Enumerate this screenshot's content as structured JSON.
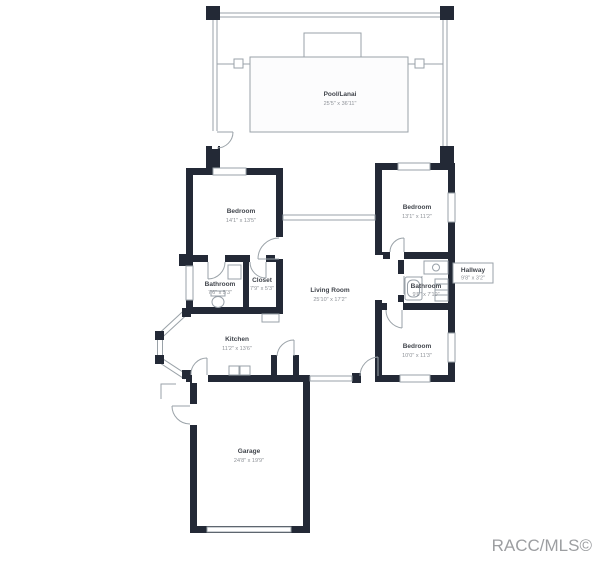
{
  "watermark": "RACC/MLS©",
  "colors": {
    "wall": "#232936",
    "thin_line": "#9aa2a8",
    "room_name_text": "#41454c",
    "dimension_text": "#8e9298",
    "watermark_text": "#9c9ea1",
    "background": "#ffffff"
  },
  "rooms": {
    "pool": {
      "name": "Pool/Lanai",
      "dims": "25'5\" x 36'11\""
    },
    "bedroom_master": {
      "name": "Bedroom",
      "dims": "14'1\" x 13'5\""
    },
    "bedroom_ne": {
      "name": "Bedroom",
      "dims": "13'1\" x 11'2\""
    },
    "bathroom_w": {
      "name": "Bathroom",
      "dims": "7'6\" x 5'3\""
    },
    "closet": {
      "name": "Closet",
      "dims": "7'9\" x 5'3\""
    },
    "living": {
      "name": "Living Room",
      "dims": "25'10\" x 17'2\""
    },
    "bathroom_e": {
      "name": "Bathroom",
      "dims": "9'6\" x 7'10\""
    },
    "hallway": {
      "name": "Hallway",
      "dims": "9'8\" x 3'2\""
    },
    "bedroom_se": {
      "name": "Bedroom",
      "dims": "10'0\" x 11'3\""
    },
    "kitchen": {
      "name": "Kitchen",
      "dims": "11'2\" x 13'6\""
    },
    "garage": {
      "name": "Garage",
      "dims": "24'8\" x 19'9\""
    }
  }
}
